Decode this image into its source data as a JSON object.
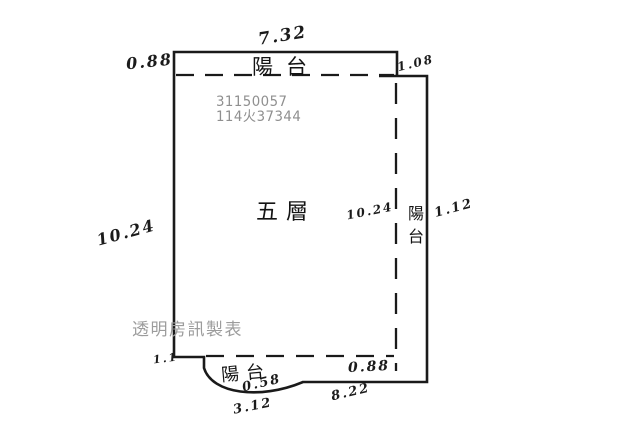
{
  "page": {
    "background": "#ffffff",
    "type": "floor-plan-sketch"
  },
  "plan": {
    "unit_label": "五層",
    "registration_numbers": [
      "31150057",
      "114火37344"
    ],
    "balcony_top_label": "陽台",
    "balcony_right_label": "陽台",
    "balcony_bottom_label": "陽台",
    "dimensions": {
      "top": "7.32",
      "top_left": "0.88",
      "top_right": "1.08",
      "left": "10.24",
      "interior_right": "10.24",
      "right": "1.12",
      "bottom_left": "1.1",
      "bottom_balcony_depth": "0.58",
      "bottom_balcony_width": "3.12",
      "bottom_inner": "0.88",
      "bottom_right": "8.22"
    },
    "watermark": "透明房訊製表",
    "colors": {
      "outline": "#1a1a1a",
      "registration_text": "#8f8f8f",
      "watermark_text": "#9c9c9c",
      "handwriting": "#1b1b1b"
    }
  }
}
